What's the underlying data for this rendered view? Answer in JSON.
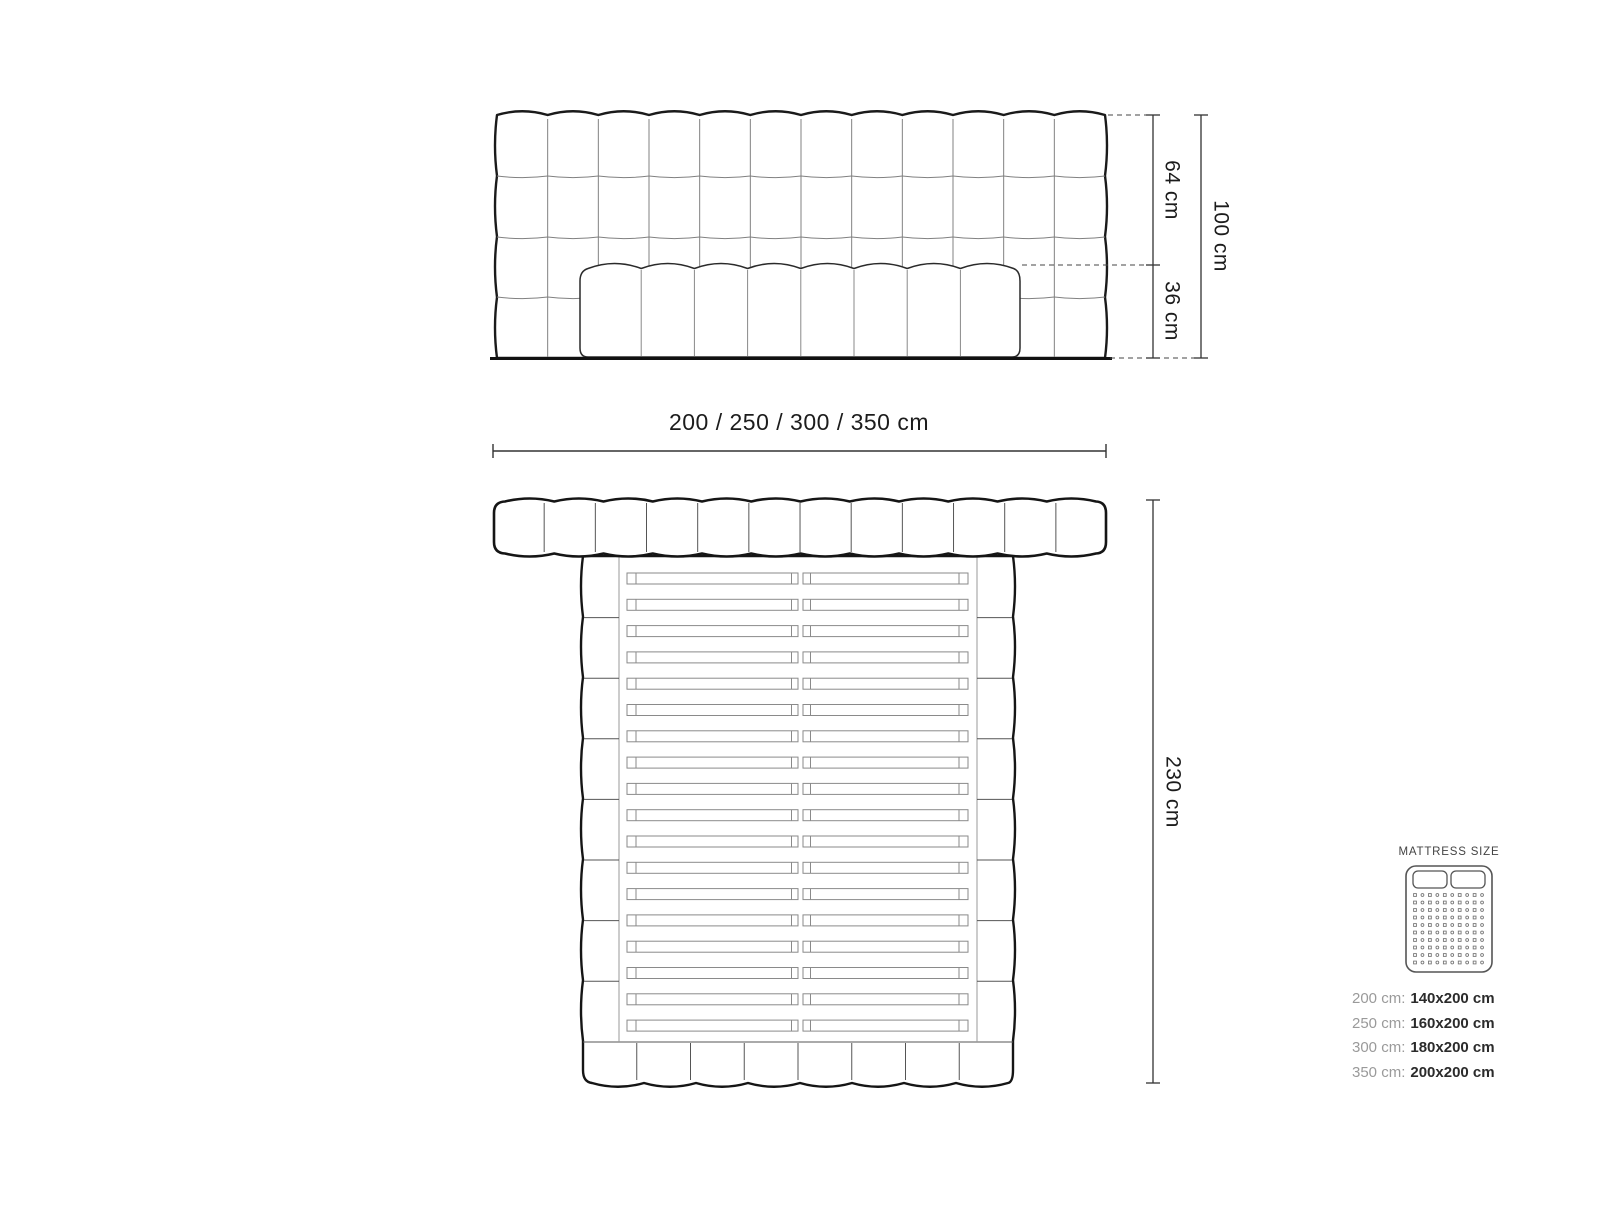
{
  "front_view": {
    "upper_height": "64 cm",
    "lower_height": "36 cm",
    "total_height": "100 cm",
    "width_options": "200 / 250 / 300 / 350 cm"
  },
  "top_view": {
    "length": "230 cm"
  },
  "mattress_legend": {
    "title": "MATTRESS SIZE",
    "rows": [
      {
        "label": "200 cm:",
        "value": "140x200 cm"
      },
      {
        "label": "250 cm:",
        "value": "160x200 cm"
      },
      {
        "label": "300 cm:",
        "value": "180x200 cm"
      },
      {
        "label": "350 cm:",
        "value": "200x200 cm"
      }
    ]
  },
  "colors": {
    "outline_dark": "#1a1a1a",
    "tuft_line": "#818181",
    "dim_line": "#333333",
    "text_dark": "#1c1c1c",
    "text_gray": "#9a9a9a"
  }
}
